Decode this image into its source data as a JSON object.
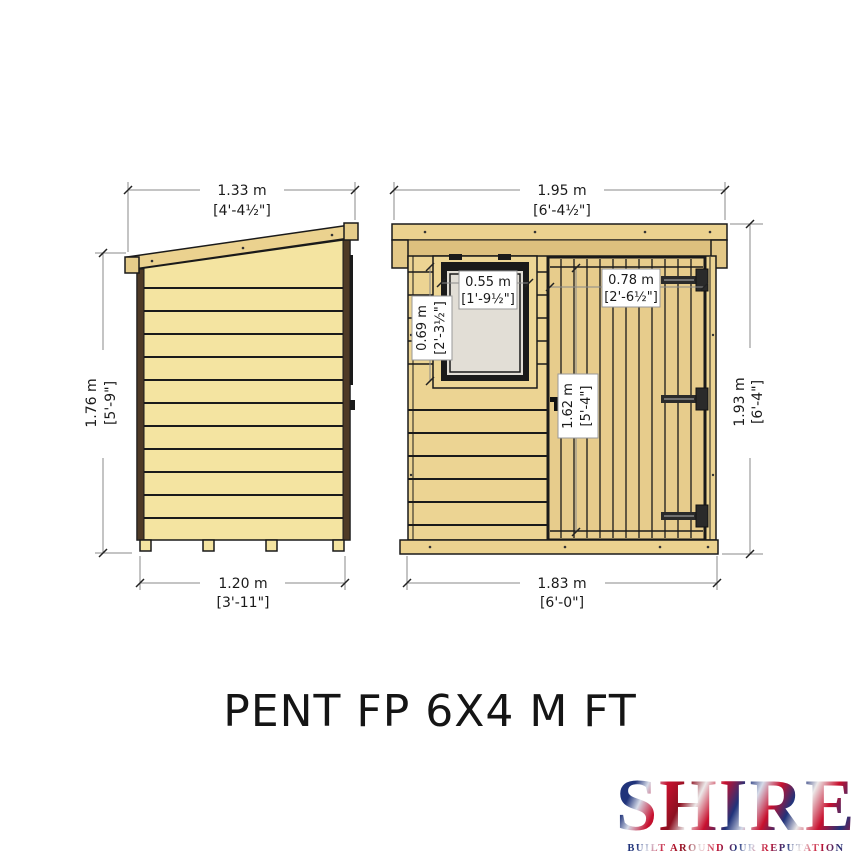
{
  "title": "PENT FP 6X4 M FT",
  "dims": {
    "side_roof_width": {
      "metric": "1.33 m",
      "imperial": "[4'-4½\"]"
    },
    "side_wall_height": {
      "metric": "1.76 m",
      "imperial": "[5'-9\"]"
    },
    "side_base_width": {
      "metric": "1.20 m",
      "imperial": "[3'-11\"]"
    },
    "front_roof_width": {
      "metric": "1.95 m",
      "imperial": "[6'-4½\"]"
    },
    "front_total_height": {
      "metric": "1.93 m",
      "imperial": "[6'-4\"]"
    },
    "front_base_width": {
      "metric": "1.83 m",
      "imperial": "[6'-0\"]"
    },
    "window_width": {
      "metric": "0.55 m",
      "imperial": "[1'-9½\"]"
    },
    "window_height": {
      "metric": "0.69 m",
      "imperial": "[2'-3½\"]"
    },
    "door_width": {
      "metric": "0.78 m",
      "imperial": "[2'-6½\"]"
    },
    "door_height": {
      "metric": "1.62 m",
      "imperial": "[5'-4\"]"
    }
  },
  "logo": {
    "brand": "SHIRE",
    "tagline": "BUILT AROUND OUR REPUTATION"
  },
  "colors": {
    "wood_light": "#F4E4A1",
    "wood_mid": "#ECD493",
    "wood_roof": "#EBD28F",
    "wood_band": "#DDC07E",
    "corner_trim": "#4E3A26",
    "outline": "#1a1a1a",
    "glass": "#E2DED6",
    "dim_line": "#8a8a8a",
    "label_border": "#999999",
    "logo_navy": "#20337a",
    "logo_red": "#c8102e"
  }
}
